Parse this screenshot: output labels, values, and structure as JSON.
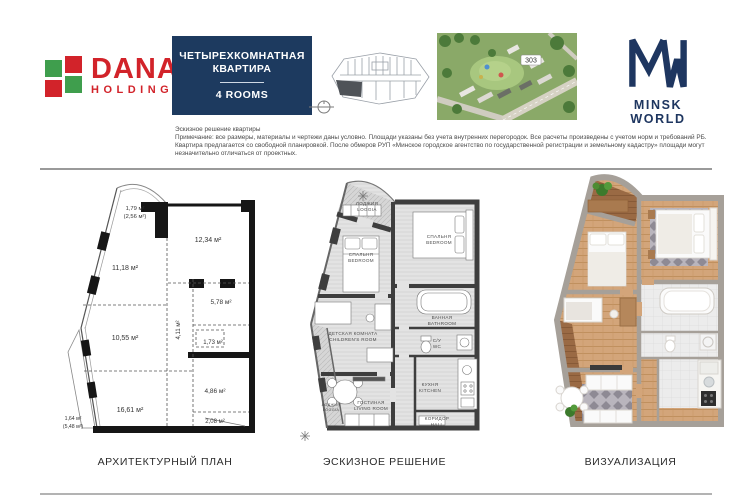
{
  "header": {
    "dana_logo": {
      "name": "DANA",
      "sub": "HOLDINGS"
    },
    "title_block": {
      "line1": "ЧЕТЫРЕХКОМНАТНАЯ",
      "line2": "КВАРТИРА",
      "rooms": "4 ROOMS"
    },
    "aerial": {
      "marker": "303"
    },
    "mw_logo": {
      "wordmark": "MINSK WORLD"
    }
  },
  "disclaimer": {
    "title": "Эскизное решение квартиры",
    "body": "Примечание: все размеры, материалы и чертежи даны условно. Площади указаны без учета внутренних перегородок. Все расчеты произведены с учетом норм и требований РБ. Квартира предлагается со свободной планировкой. После обмеров РУП «Минское городское агентство по государственной регистрации и земельному кадастру» площади могут незначительно отличаться от проектных."
  },
  "plans": {
    "architectural": {
      "caption": "АРХИТЕКТУРНЫЙ ПЛАН",
      "areas": {
        "loggia_top": "1,79 м²",
        "loggia_top_total": "(2,56 м²)",
        "room_top_right": "12,34 м²",
        "room_upper_left": "11,18 м²",
        "room_mid_right": "5,78 м²",
        "corridor": "4,11 м²",
        "room_mid_left": "10,55 м²",
        "storage": "1,73 м²",
        "bathroom": "4,86 м²",
        "room_bottom_left": "16,61 м²",
        "wc": "2,08 м²",
        "loggia_bottom": "1,64 м²",
        "loggia_bottom_total": "(5,48 м²)"
      }
    },
    "sketch": {
      "caption": "ЭСКИЗНОЕ РЕШЕНИЕ",
      "rooms": {
        "loggia_top": {
          "ru": "ЛОДЖИЯ",
          "en": "LOGGIA"
        },
        "bedroom_left": {
          "ru": "СПАЛЬНЯ",
          "en": "BEDROOM"
        },
        "bedroom_right": {
          "ru": "СПАЛЬНЯ",
          "en": "BEDROOM"
        },
        "bathroom": {
          "ru": "ВАННАЯ",
          "en": "BATHROOM"
        },
        "wc": {
          "ru": "С/У",
          "en": "WC"
        },
        "children": {
          "ru": "ДЕТСКАЯ КОМНАТА",
          "en": "CHILDREN'S ROOM"
        },
        "kitchen": {
          "ru": "КУХНЯ",
          "en": "KITCHEN"
        },
        "living": {
          "ru": "ГОСТИНАЯ",
          "en": "LIVING ROOM"
        },
        "loggia_bottom": {
          "ru": "ЛОДЖИЯ",
          "en": "LOGGIA"
        },
        "hall": {
          "ru": "КОРИДОР",
          "en": "HALL"
        }
      }
    },
    "visualization": {
      "caption": "ВИЗУАЛИЗАЦИЯ"
    }
  },
  "colors": {
    "navy": "#1d3a5f",
    "brand_red": "#d2232a",
    "brand_green": "#3f9e4d",
    "wall_dark": "#161616",
    "sketch_wall": "#3e3e3e",
    "render_wall": "#a6a099",
    "wood": "#d2a377"
  }
}
